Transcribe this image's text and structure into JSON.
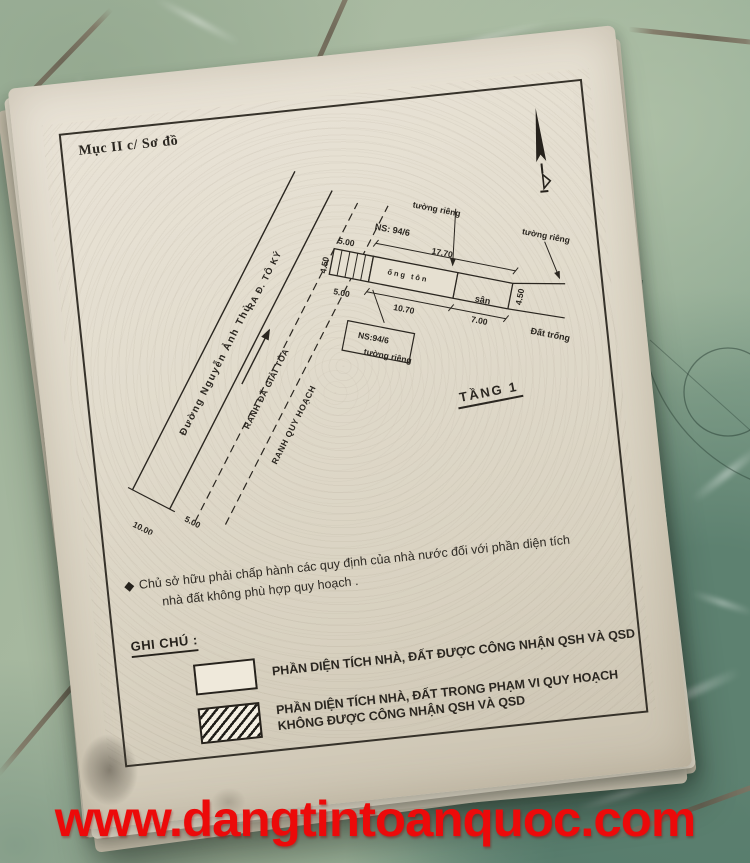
{
  "scene": {
    "watermark_text": "www.dangtintoanquoc.com"
  },
  "document": {
    "section_label": "Mục II c/ Sơ đồ",
    "floor_label": "TẦNG 1",
    "note": {
      "bullet": "◆",
      "line1": "Chủ sở hữu phải chấp hành các quy định của nhà nước đối với phần diện tích",
      "line2": "nhà đất không phù hợp quy hoạch ."
    },
    "legend": {
      "title": "GHI CHÚ :",
      "items": [
        {
          "symbol": "plain-box",
          "label": "PHẦN DIỆN TÍCH NHÀ, ĐẤT ĐƯỢC CÔNG NHẬN QSH VÀ QSD"
        },
        {
          "symbol": "hatched-box",
          "label_line1": "PHẦN DIỆN TÍCH NHÀ, ĐẤT TRONG PHẠM VI QUY HOẠCH",
          "label_line2": "KHÔNG ĐƯỢC CÔNG NHẬN QSH VÀ QSD"
        }
      ]
    },
    "plan": {
      "road_name": "Đường Nguyễn Ảnh Thủ",
      "road_direction": "RA Đ. TÔ KÝ",
      "boundary_cleared": "RANH ĐÃ GIẢI TỎA",
      "boundary_planning": "RANH QUY HOẠCH",
      "house_no_top": "NS: 94/6",
      "house_no_bottom": "NS:94/6",
      "house_text": "ống tôn",
      "yard": "sân",
      "vacant": "Đất trống",
      "wall_label": "tường riêng",
      "dims": {
        "road_width": "10.00",
        "road_offset": "5.00",
        "hatch_top": "5.00",
        "hatch_bottom": "5.00",
        "front_total": "17.70",
        "house_bottom": "10.70",
        "yard_bottom": "7.00",
        "depth_left": "4.50",
        "depth_right": "4.50"
      }
    }
  },
  "colors": {
    "paper": "#e2dccd",
    "ink": "#2b2721",
    "tile_light": "#a3b49c",
    "tile_dark": "#5d8170",
    "grout": "#7e7362",
    "watermark_red": "#ec0a0a"
  }
}
